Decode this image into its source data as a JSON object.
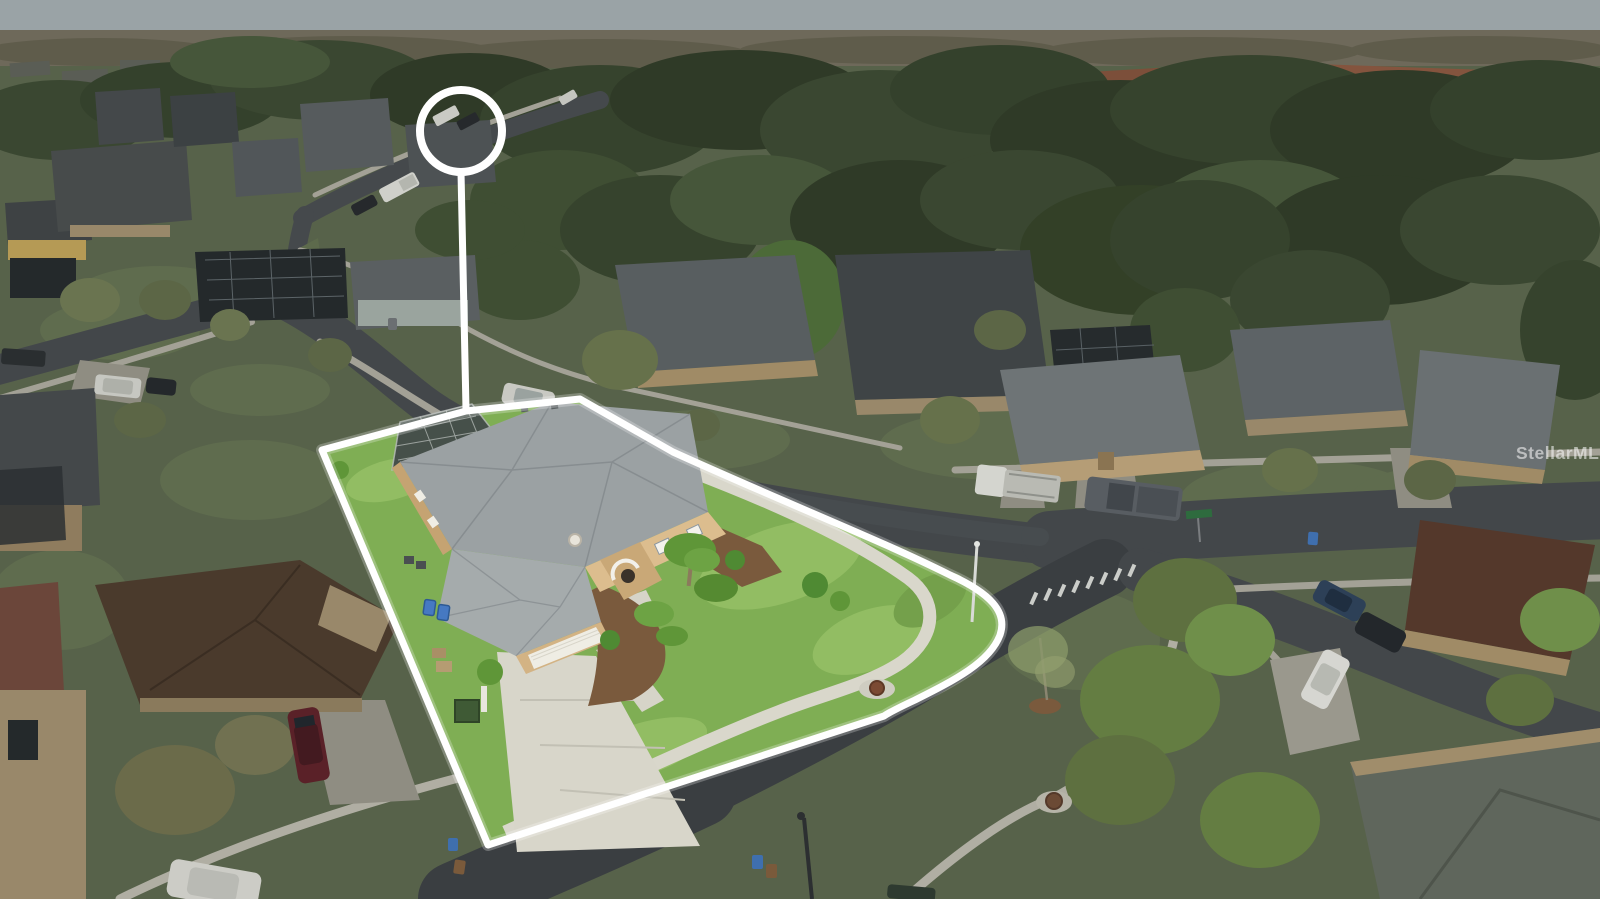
{
  "meta": {
    "kind": "aerial-real-estate-photo",
    "width": 1600,
    "height": 899
  },
  "watermark": {
    "text": "StellarMLS",
    "color": "rgba(255,255,255,0.55)"
  },
  "marker": {
    "ring_color": "#ffffff",
    "shape": "circle-with-stem"
  },
  "outline": {
    "color": "#ffffff",
    "stroke_width": 7
  },
  "palette": {
    "sky": "#9aa3a6",
    "horizon_band": "#6e695a",
    "forest_dark": "#2f3a27",
    "forest_mid": "#3a4731",
    "forest_light": "#46563a",
    "ground_dim": "#57624a",
    "lawn_bright": "#7fae54",
    "lawn_highlight": "#92bd63",
    "road": "#43474a",
    "road_light": "#4b5053",
    "sidewalk_dim": "#a3a196",
    "sidewalk_bright": "#d9d7cb",
    "driveway_bright": "#d8d6ca",
    "roof_gray_bright": "#9ba1a3",
    "roof_gray_dim": "#575d5f",
    "roof_charcoal": "#3f4446",
    "roof_brown": "#4a3a2c",
    "roof_terracotta": "#7c4f3a",
    "wall_tan_bright": "#dcbd8e",
    "wall_tan_dim": "#99886a",
    "garage_door": "#efede4",
    "mulch": "#7a5a3d",
    "crosswalk": "#cbcdc9",
    "recycle_bin_blue": "#4679c2"
  }
}
